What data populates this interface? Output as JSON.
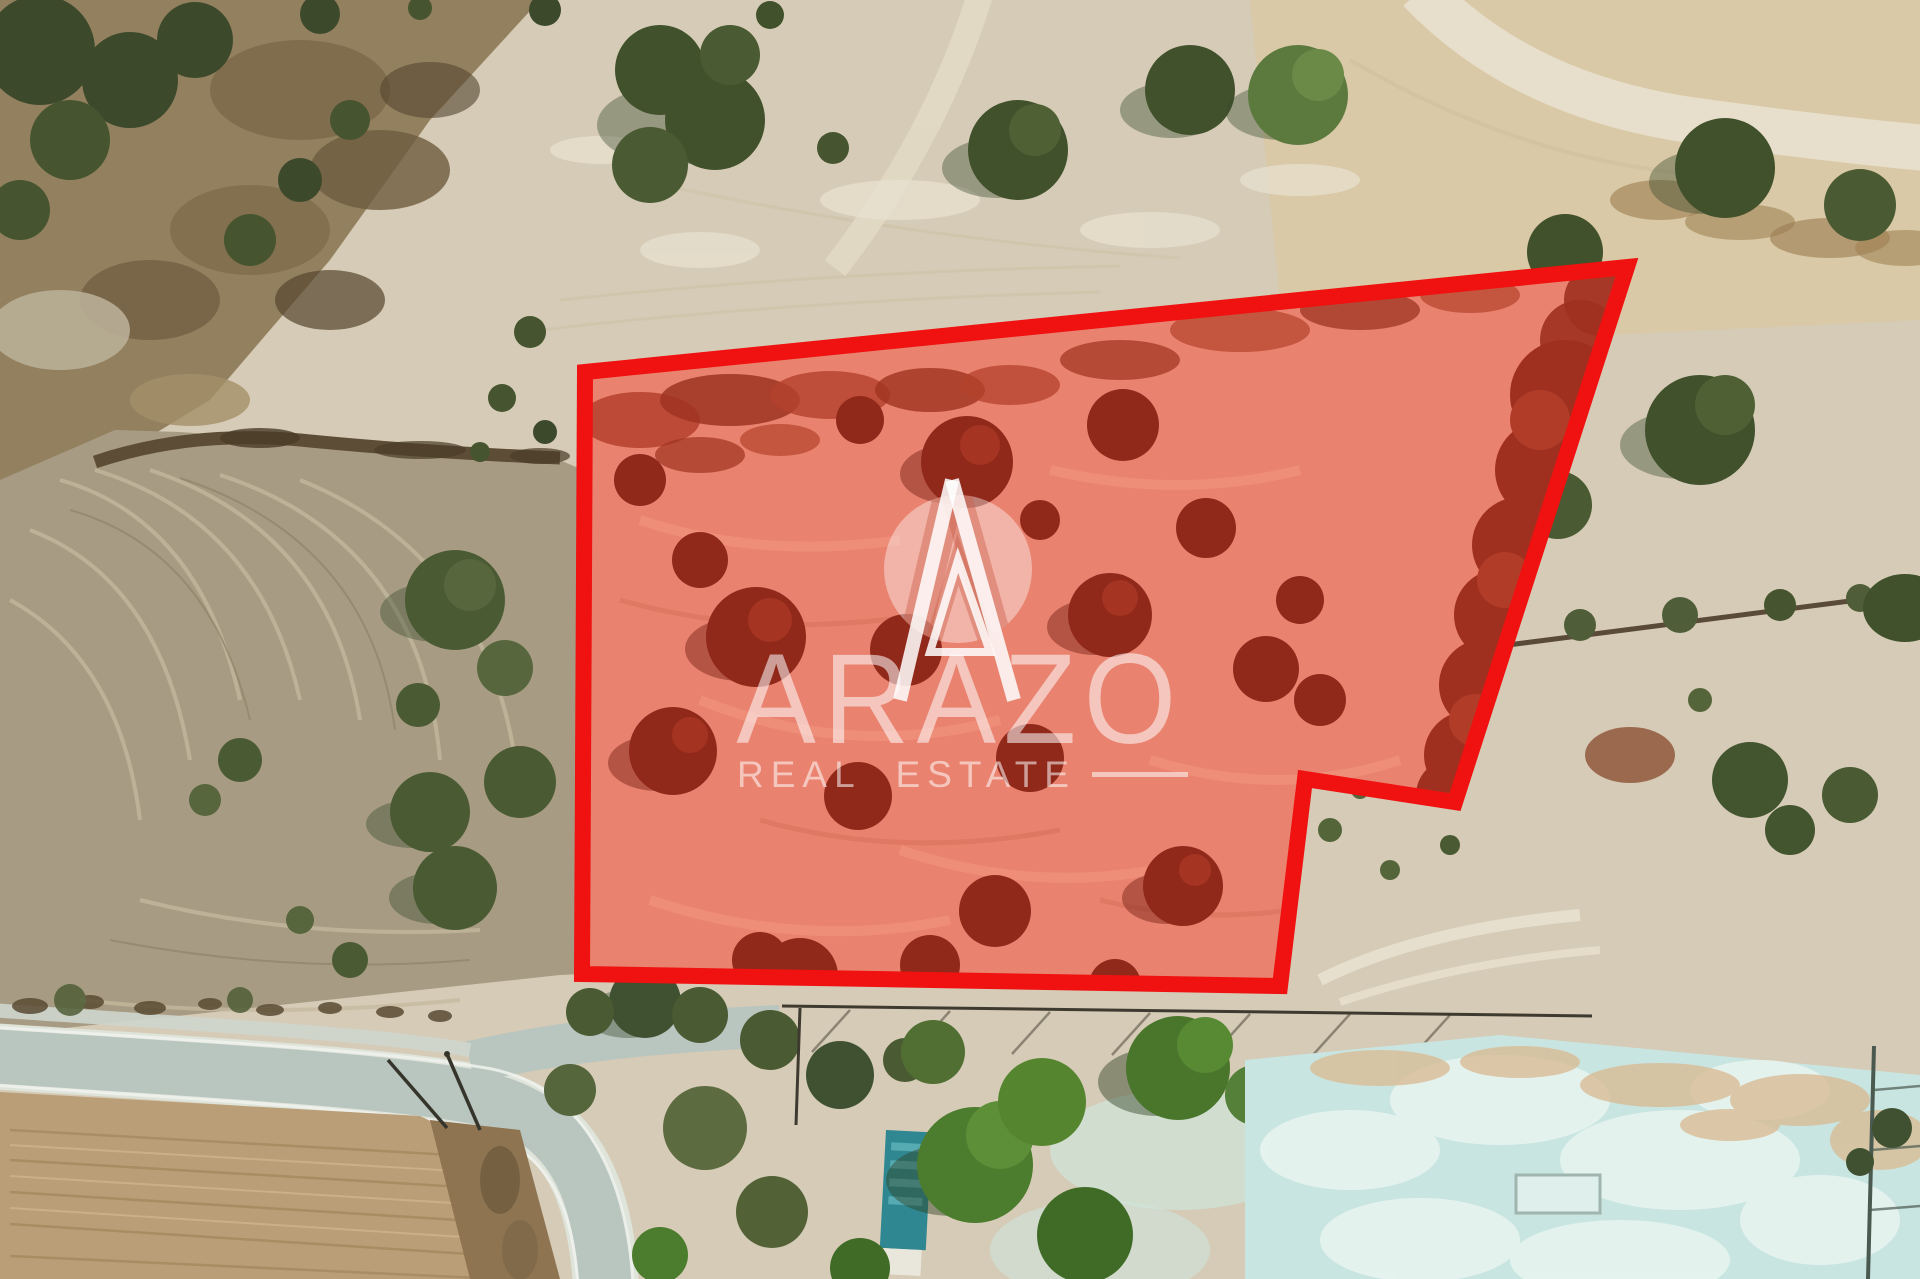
{
  "image": {
    "width": 1920,
    "height": 1279,
    "kind": "aerial-drone-photo",
    "subject": "dry agricultural land with olive trees; a land parcel for sale is outlined in red and tinted red"
  },
  "watermark": {
    "brand": "ARAZO",
    "tagline": "REAL ESTATE",
    "logo": "circle-A-monogram",
    "color": "#ffffff"
  },
  "parcel": {
    "points": "585,372 1627,267 1455,802 1305,779 1280,986 582,974",
    "outline_color": "#f01111",
    "outline_width": 16,
    "fill_tint": "rgba(232,72,55,0.18)"
  },
  "palette": {
    "ground_pale": "#d5cbb6",
    "ground_light": "#e6dfcd",
    "field_gray": "#a79c83",
    "field_tan": "#b99e77",
    "scrub_brown": "#93805f",
    "hedge_dark": "#5a4b33",
    "tree_dark": "#41512c",
    "tree_bright": "#4c7c2e",
    "road": "#b9c5bf",
    "curb": "#eef1ec",
    "pond": "#c9e5e1",
    "pond_white": "#eef7f3",
    "parcel_ground": "#e98f7b",
    "parcel_tree": "#7e2315",
    "building_teal": "#2f8791"
  }
}
